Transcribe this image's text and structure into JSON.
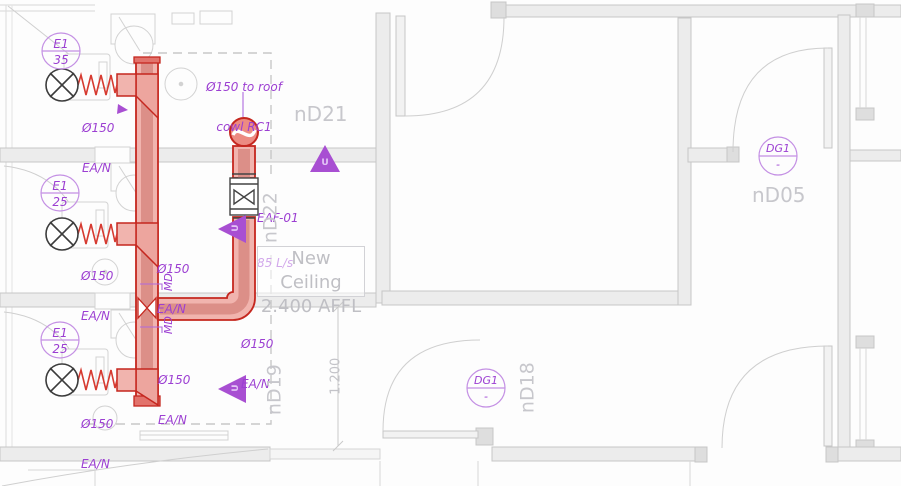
{
  "drawing": {
    "tags": [
      {
        "code": "E1",
        "value": "35"
      },
      {
        "code": "E1",
        "value": "25"
      },
      {
        "code": "E1",
        "value": "25"
      }
    ],
    "size_labels": [
      {
        "dia": "Ø150",
        "sys": "EA/N"
      },
      {
        "dia": "Ø150",
        "sys": "EA/N"
      },
      {
        "dia": "Ø150",
        "sys": "EA/N"
      },
      {
        "dia": "Ø150",
        "sys": "EA/N"
      },
      {
        "dia": "Ø150",
        "sys": "EA/N"
      },
      {
        "dia": "Ø150",
        "sys": "EA/N"
      }
    ],
    "roof_note": {
      "line1": "Ø150 to roof",
      "line2": "cowl RC1"
    },
    "fan_label": {
      "id": "EAF-01",
      "flow": "85 L/s"
    },
    "damper_labels": [
      "MD",
      "MD"
    ],
    "stat_labels": [
      "U",
      "U",
      "U"
    ],
    "grille_tags": [
      {
        "code": "DG1",
        "value": "-"
      },
      {
        "code": "DG1",
        "value": "-"
      }
    ],
    "rooms": {
      "nd21": "nD21",
      "nd22": "nD22",
      "nd19": "nD19",
      "nd18": "nD18",
      "nd05": "nD05"
    },
    "ceiling_note": {
      "line1": "New Ceiling",
      "line2": "2.400 AFFL"
    },
    "dimension": "1.200"
  },
  "colors": {
    "duct_outline": "#c5271f",
    "duct_fill": "#f1b4ae",
    "duct_stripe": "#dc8f88",
    "annotation_purple": "#9c3fd2",
    "symbol_purple": "#a84fd2",
    "plan_gray": "#c9c9c9",
    "label_gray": "#c7c7cc"
  }
}
